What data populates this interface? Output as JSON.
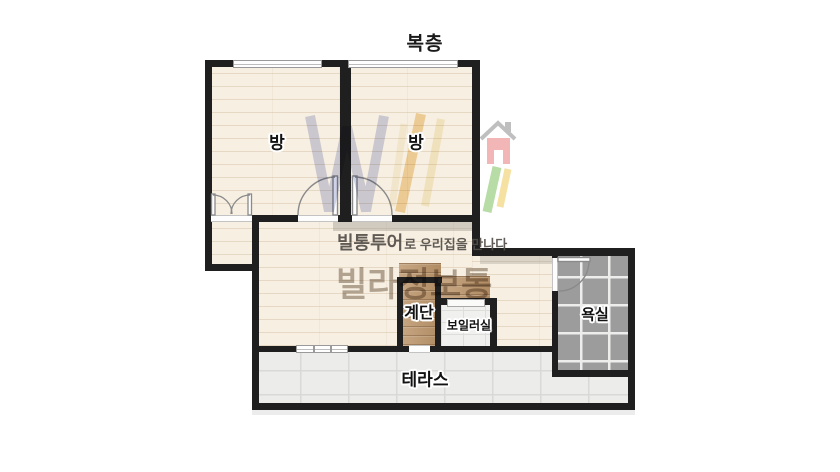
{
  "title": "복층",
  "rooms": {
    "bedroom_left": "방",
    "bedroom_right": "방",
    "stairs": "계단",
    "boiler": "보일러실",
    "bathroom": "욕실",
    "terrace": "테라스"
  },
  "watermark": {
    "slogan_bold": "빌통투어",
    "slogan_rest": "로 우리집을 만나다",
    "brand": "빌라정보통"
  },
  "icons": {
    "door_swing": "door-swing-icon",
    "double_door": "double-door-swing-icon",
    "window": "window-symbol",
    "logo_w": "w-mark-icon",
    "logo_house": "house-icon"
  },
  "colors": {
    "wall": "#1f1f1f",
    "floor": "#f7efe2",
    "wood": "#bb9469",
    "terrace_tile": "#ececea",
    "boiler_tile": "#f0f0ee",
    "bath_tile": "#9c9c9c",
    "logo_blue": "#abb3d6",
    "logo_gold": "#e9b85c",
    "logo_pale_yellow": "#f3e3b4",
    "logo_red": "#e25858",
    "logo_green": "#7cbf5a",
    "brand_text": "#8b7a69",
    "slogan_text": "#534e48"
  }
}
